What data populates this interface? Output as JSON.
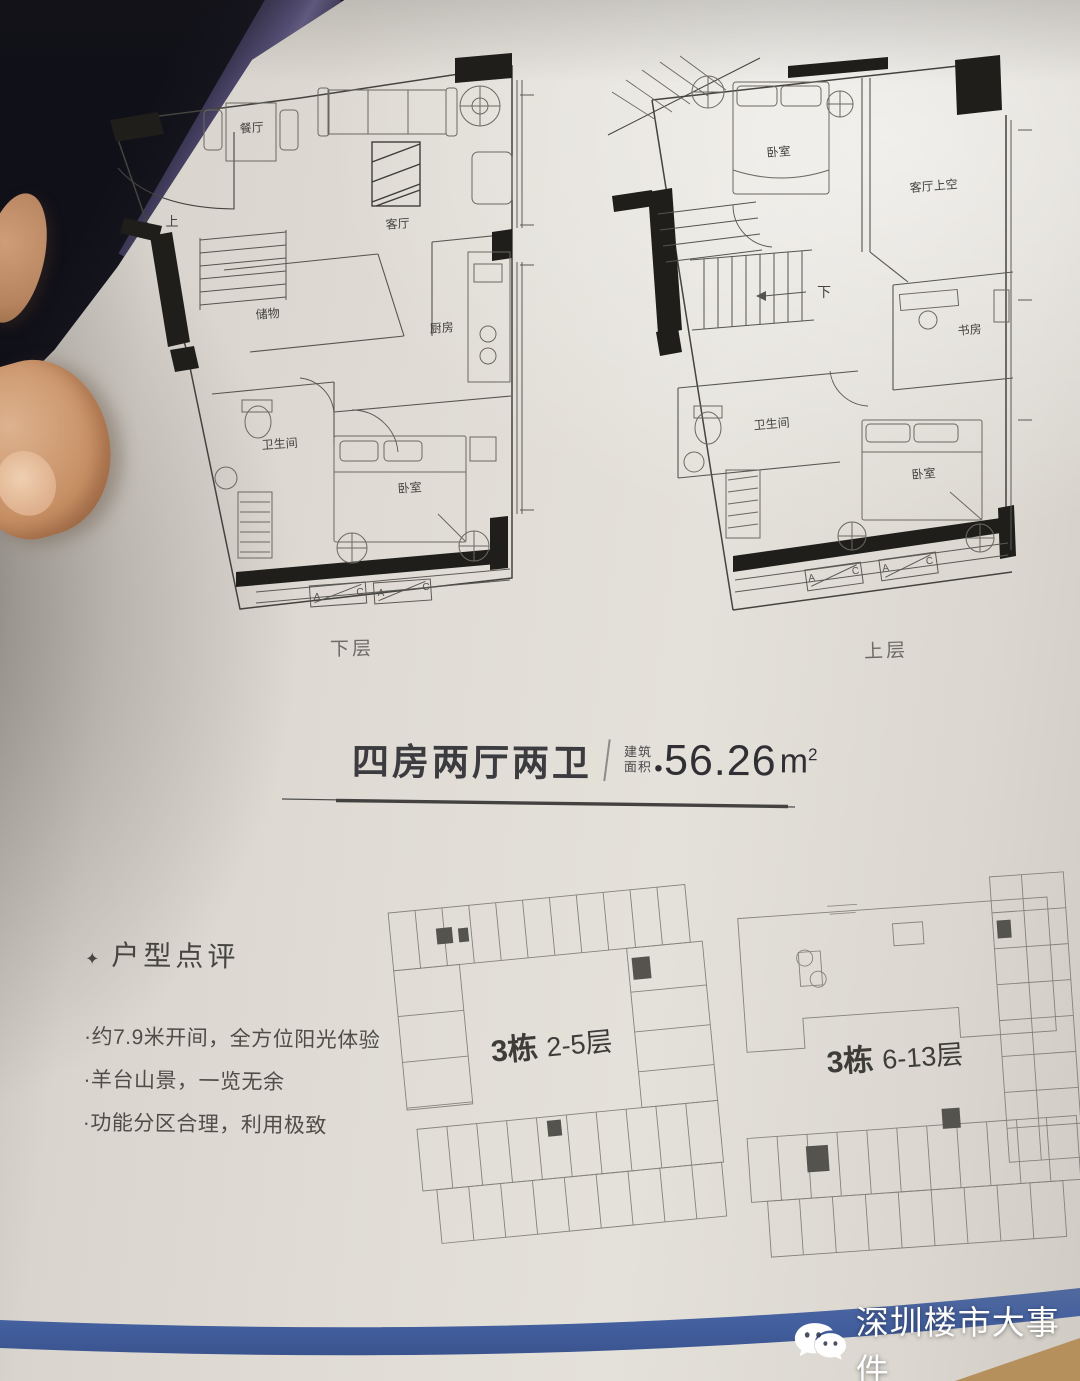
{
  "title": {
    "name": "四房两厅两卫",
    "area_label": [
      "建筑",
      "面积"
    ],
    "dot": "●",
    "value": "56.26",
    "unit": "m",
    "sup": "2"
  },
  "plans": {
    "lower": {
      "caption": "下层",
      "rooms": {
        "dining": "餐厅",
        "living": "客厅",
        "kitchen": "厨房",
        "storage": "储物",
        "bath": "卫生间",
        "bedroom": "卧室",
        "stair": "上"
      },
      "marks": [
        "A",
        "C",
        "A",
        "C"
      ]
    },
    "upper": {
      "caption": "上层",
      "rooms": {
        "bedroom_top": "卧室",
        "void": "客厅上空",
        "study": "书房",
        "bath": "卫生间",
        "bedroom": "卧室",
        "stair": "下"
      },
      "marks": [
        "A",
        "C",
        "A",
        "C"
      ]
    }
  },
  "review": {
    "star": "✦",
    "heading": "户型点评",
    "bullets": [
      "·约7.9米开间，全方位阳光体验",
      "·羊台山景，一览无余",
      "·功能分区合理，利用极致"
    ]
  },
  "keyplans": {
    "left": {
      "building": "3栋",
      "floors": "2-5层"
    },
    "right": {
      "building": "3栋",
      "floors": "6-13层"
    }
  },
  "watermark": {
    "text": "深圳楼市大事件"
  },
  "colors": {
    "stripe": "#44609f",
    "paper": "#d9d5ce",
    "ink": "#3c3a38"
  }
}
